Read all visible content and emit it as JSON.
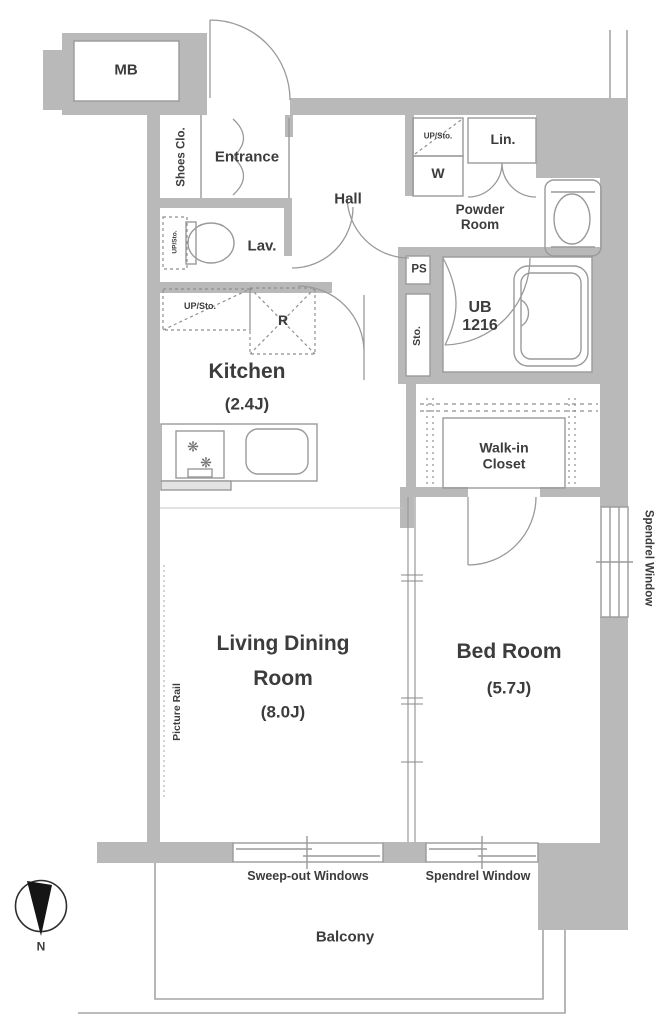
{
  "plan": {
    "rooms": {
      "mb": "MB",
      "shoes_closet": "Shoes Clo.",
      "entrance": "Entrance",
      "hall": "Hall",
      "lavatory": "Lav.",
      "powder_room_line1": "Powder",
      "powder_room_line2": "Room",
      "washer": "W",
      "linen": "Lin.",
      "up_sto_powder": "UP/Sto.",
      "up_sto_lav": "UP/Sto.",
      "up_sto_kitchen": "UP/Sto.",
      "pipe_space": "PS",
      "storage": "Sto.",
      "unit_bath_line1": "UB",
      "unit_bath_line2": "1216",
      "refrigerator": "R",
      "kitchen": "Kitchen",
      "kitchen_size": "(2.4J)",
      "walk_in_closet_line1": "Walk-in",
      "walk_in_closet_line2": "Closet",
      "living_line1": "Living Dining",
      "living_line2": "Room",
      "living_size": "(8.0J)",
      "bedroom": "Bed Room",
      "bedroom_size": "(5.7J)",
      "balcony": "Balcony"
    },
    "features": {
      "picture_rail": "Picture Rail",
      "spendrel_window_side": "Spendrel Window",
      "spendrel_window_bottom": "Spendrel Window",
      "sweep_out_windows": "Sweep-out Windows"
    },
    "compass": {
      "north": "N"
    },
    "icons": {
      "burner": "❋"
    },
    "colors": {
      "wall": "#b9b9b9",
      "line": "#9a9a9a",
      "text": "#3c3c3c",
      "background": "#ffffff"
    }
  }
}
